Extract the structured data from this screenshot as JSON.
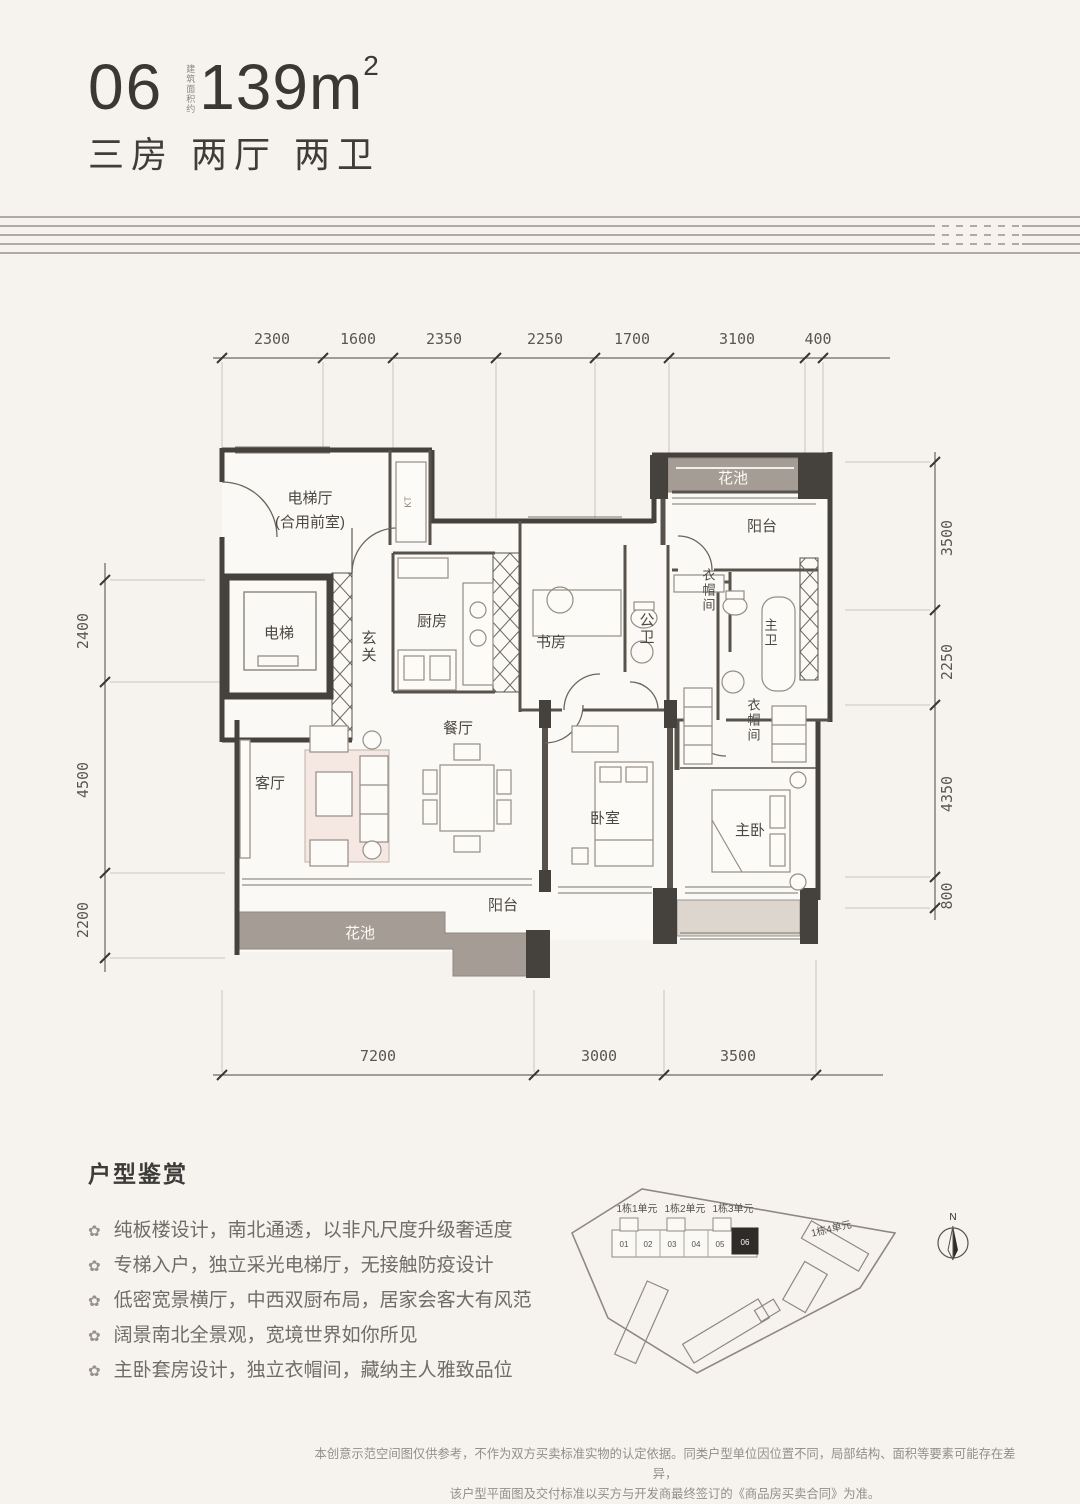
{
  "header": {
    "unit_number": "06",
    "area_prefix": "建筑面积约",
    "area_value": "139m",
    "area_exponent": "2",
    "layout_text": "三房 两厅 两卫"
  },
  "plan": {
    "dims_top": [
      "2300",
      "1600",
      "2350",
      "2250",
      "1700",
      "3100",
      "400"
    ],
    "dims_left": [
      "2400",
      "4500",
      "2200"
    ],
    "dims_right": [
      "3500",
      "2250",
      "4350",
      "800"
    ],
    "dims_bottom": [
      "7200",
      "3000",
      "3500"
    ],
    "rooms": {
      "lift_lobby_line1": "电梯厅",
      "lift_lobby_line2": "(合用前室)",
      "lift": "电梯",
      "entry": "玄关",
      "kitchen": "厨房",
      "kt": "KT",
      "study": "书房",
      "guest_bath": "公卫",
      "flower_bed_top": "花池",
      "balcony_top": "阳台",
      "cloakroom_top": "衣帽间",
      "master_bath": "主卫",
      "dining": "餐厅",
      "living": "客厅",
      "bedroom": "卧室",
      "cloakroom_master": "衣帽间",
      "master_bedroom": "主卧",
      "balcony_bottom": "阳台",
      "flower_bed_bottom": "花池"
    }
  },
  "features": {
    "title": "户型鉴赏",
    "bullet_icon": "✿",
    "items": [
      "纯板楼设计，南北通透，以非凡尺度升级奢适度",
      "专梯入户，独立采光电梯厅，无接触防疫设计",
      "低密宽景横厅，中西双厨布局，居家会客大有风范",
      "阔景南北全景观，宽境世界如你所见",
      "主卧套房设计，独立衣帽间，藏纳主人雅致品位"
    ]
  },
  "site_plan": {
    "building_labels": [
      "1栋1单元",
      "1栋2单元",
      "1栋3单元",
      "1栋4单元"
    ],
    "units": [
      "01",
      "02",
      "03",
      "04",
      "05"
    ],
    "highlighted_unit": "06",
    "compass": "N"
  },
  "disclaimer": {
    "line1": "本创意示范空间图仅供参考，不作为双方买卖标准实物的认定依据。同类户型单位因位置不同，局部结构、面积等要素可能存在差异，",
    "line2": "该户型平面图及交付标准以买方与开发商最终签订的《商品房买卖合同》为准。"
  },
  "colors": {
    "wall": "#45413d",
    "gray_fill": "#a59d95",
    "pink": "#f5e7e2",
    "line": "#948d85"
  }
}
